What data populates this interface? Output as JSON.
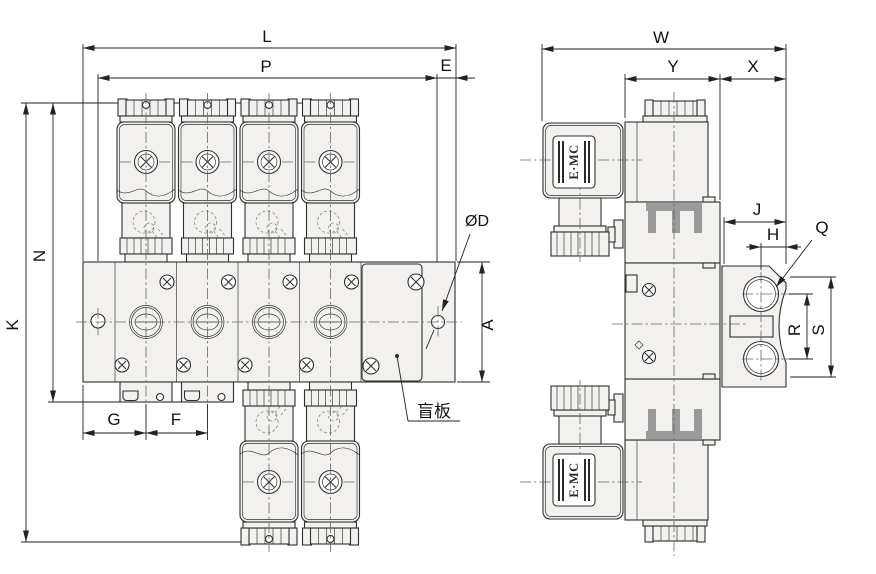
{
  "colors": {
    "line": "#2f2f2f",
    "body_fill": "#f2f1ee",
    "detail_gray": "#9a9a9a",
    "background": "#ffffff"
  },
  "front_view": {
    "dims": {
      "L": "L",
      "P": "P",
      "E": "E",
      "K": "K",
      "N": "N",
      "G": "G",
      "F": "F",
      "A": "A",
      "hole_diameter": "ØD"
    },
    "blind_plate_label": "盲板"
  },
  "side_view": {
    "dims": {
      "W": "W",
      "Y": "Y",
      "X": "X",
      "J": "J",
      "H": "H",
      "Q": "Q",
      "R": "R",
      "S": "S"
    },
    "logo_top": "E·MC",
    "logo_bottom": "E·MC"
  }
}
